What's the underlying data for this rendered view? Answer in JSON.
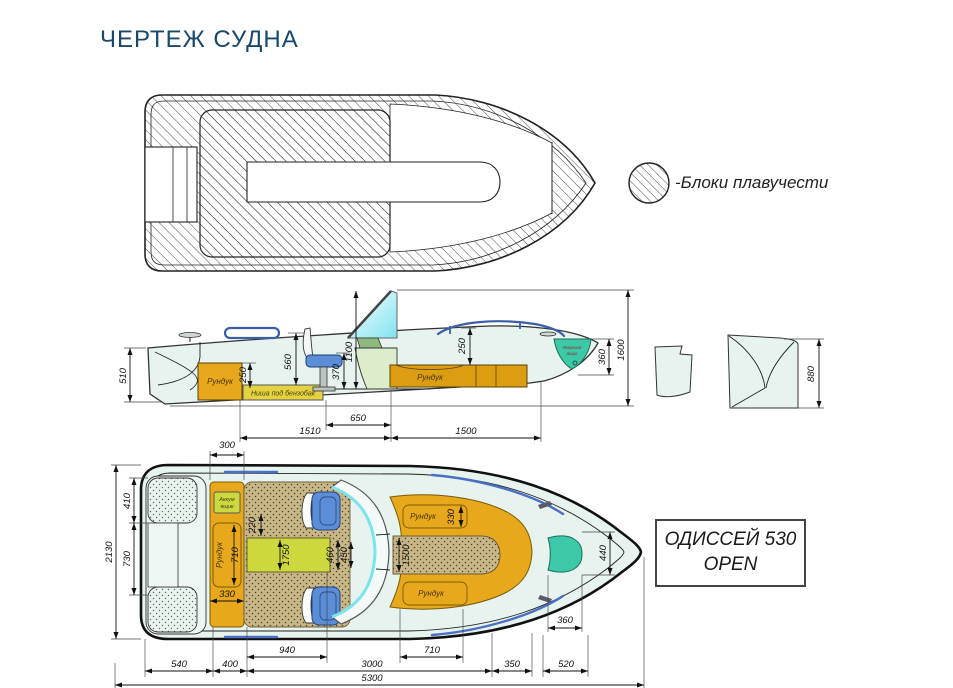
{
  "page": {
    "title": "ЧЕРТЕЖ СУДНА"
  },
  "legend": {
    "label": "-Блоки плавучести"
  },
  "model_box": {
    "line1": "ОДИССЕЙ 530",
    "line2": "OPEN"
  },
  "colors": {
    "title_blue": "#19486b",
    "hull_mint": "#e7f3ef",
    "locker_orange": "#e8a81c",
    "fuel_yellow": "#e5d243",
    "console_yellow": "#cdd83e",
    "seat_blue": "#5b8ed6",
    "anchor_teal": "#3cc9a8",
    "upholstery_tan": "#c9b686",
    "rail_blue": "#4a6fc4"
  },
  "side": {
    "locker_left": "Рундук",
    "fuel_niche": "Ниша под бензобак",
    "locker_right": "Рундук",
    "anchor1": "Якорный",
    "anchor2": "ящик",
    "d510": "510",
    "d250a": "250",
    "d560": "560",
    "d370": "370",
    "d1100": "1100",
    "d250b": "250",
    "d360": "360",
    "d1600": "1600",
    "d650": "650",
    "d1510": "1510",
    "d1500": "1500",
    "d880": "880"
  },
  "plan": {
    "battery1": "Аккум",
    "battery2": "ящик",
    "locker_port": "Рундук",
    "locker_bow_top": "Рундук",
    "locker_bow_bottom": "Рундук",
    "d300": "300",
    "d410": "410",
    "d730": "730",
    "d2130": "2130",
    "d220": "220",
    "d710side": "710",
    "d330port": "330",
    "d1750": "1750",
    "d460": "460",
    "d450": "450",
    "d1500walk": "1500",
    "d330bow": "330",
    "d440": "440",
    "d360": "360",
    "d540": "540",
    "d400": "400",
    "d940": "940",
    "d3000": "3000",
    "d710bottom": "710",
    "d350": "350",
    "d520": "520",
    "d5300": "5300"
  }
}
